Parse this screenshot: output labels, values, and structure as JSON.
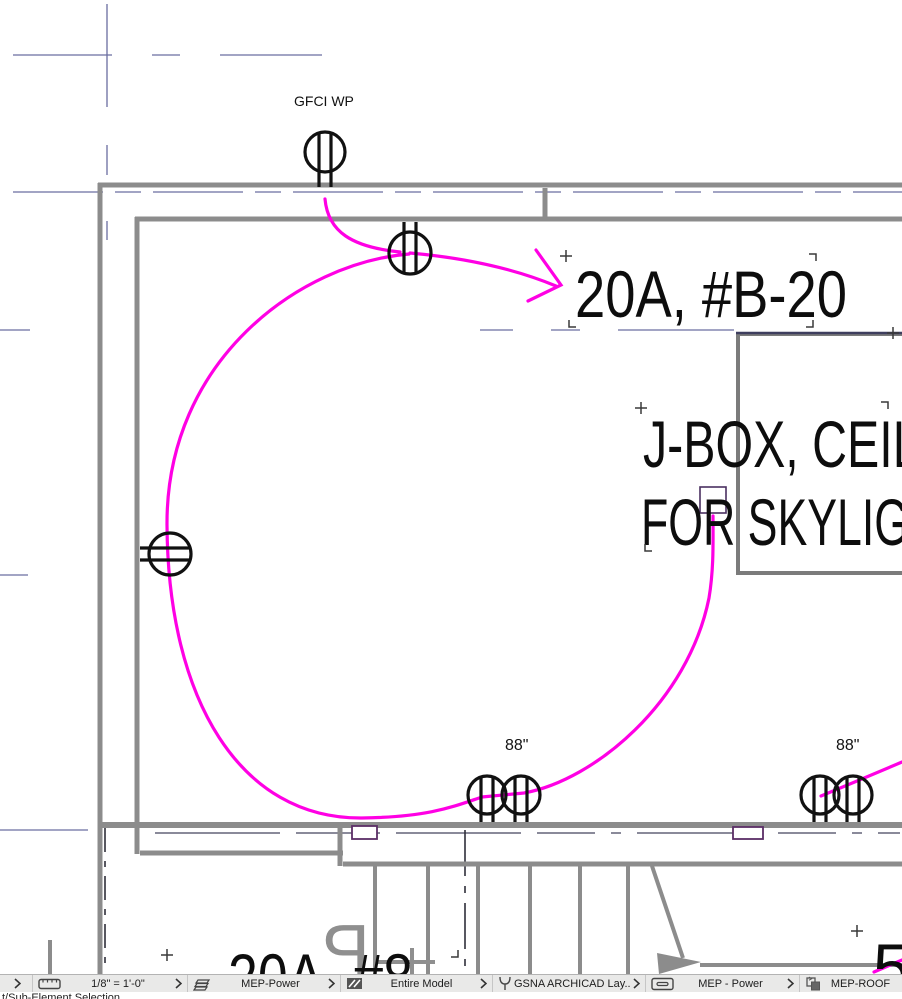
{
  "app": {
    "description": "CAD floor plan view - MEP electrical power layer"
  },
  "drawing": {
    "gfci_label": "GFCI WP",
    "circuit_label": "20A, #B-20",
    "jbox_label_line1": "J-BOX, CEILI",
    "jbox_label_line2": "FOR SKYLIG",
    "mount_height_left": "88\"",
    "mount_height_right": "88\"",
    "bottom_circuit_label": "20A, #8",
    "grid_bubble_number": "5",
    "stair_glyph": "P",
    "colors": {
      "wire": "#ff00e4",
      "wall": "#8c8c8c",
      "gridline": "#6a6da0",
      "dark_dash": "#32323f",
      "fixture_box": "#5b2e66",
      "symbol": "#111111"
    }
  },
  "statusbar": {
    "scale": "1/8\"  =  1'-0\"",
    "layers": "MEP-Power",
    "model_filter": "Entire Model",
    "layout": "GSNA ARCHICAD Lay...",
    "view": "MEP - Power",
    "paste_target": "MEP-ROOF",
    "partial_caption": "t/Sub-Element Selection"
  }
}
